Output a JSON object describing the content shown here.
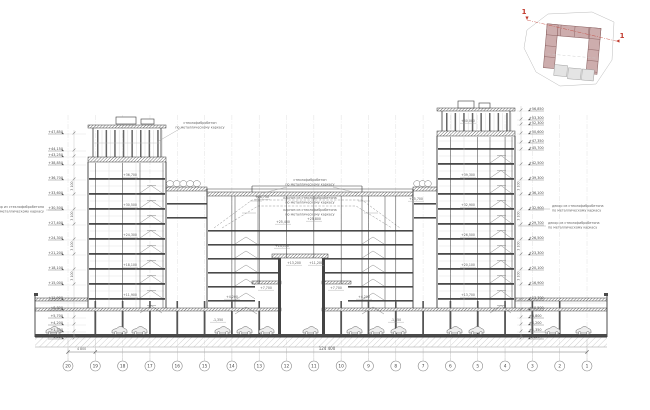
{
  "drawing_title": "Разрез 1-1",
  "grid": {
    "bubbles": [
      "20",
      "19",
      "18",
      "17",
      "16",
      "15",
      "14",
      "13",
      "12",
      "11",
      "10",
      "9",
      "8",
      "7",
      "6",
      "5",
      "4",
      "3",
      "2",
      "1"
    ]
  },
  "dimensions": {
    "overall": "124 400",
    "first_bay": "4 800",
    "floor_typical": "3 100",
    "floor_ground": "4 200"
  },
  "elevations": {
    "left": [
      {
        "y": 133,
        "label": "+47,850"
      },
      {
        "y": 150,
        "label": "+44,150"
      },
      {
        "y": 156,
        "label": "+43,250"
      },
      {
        "y": 164,
        "label": "+38,850"
      },
      {
        "y": 179,
        "label": "+36,700"
      },
      {
        "y": 194,
        "label": "+33,600"
      },
      {
        "y": 209,
        "label": "+30,500"
      },
      {
        "y": 224,
        "label": "+27,400"
      },
      {
        "y": 239,
        "label": "+24,300"
      },
      {
        "y": 254,
        "label": "+21,200"
      },
      {
        "y": 269,
        "label": "+18,100"
      },
      {
        "y": 284,
        "label": "+15,000"
      },
      {
        "y": 299,
        "label": "+11,900"
      },
      {
        "y": 309,
        "label": "+8,800"
      },
      {
        "y": 317,
        "label": "+5,700"
      },
      {
        "y": 324,
        "label": "+4,200"
      },
      {
        "y": 331,
        "label": "+1,350"
      },
      {
        "y": 338,
        "label": "-1,350"
      }
    ],
    "right": [
      {
        "y": 110,
        "label": "+56,850"
      },
      {
        "y": 119,
        "label": "+53,300"
      },
      {
        "y": 124,
        "label": "+52,300"
      },
      {
        "y": 133,
        "label": "+50,600"
      },
      {
        "y": 142,
        "label": "+47,350"
      },
      {
        "y": 149,
        "label": "+45,700"
      },
      {
        "y": 164,
        "label": "+42,500"
      },
      {
        "y": 179,
        "label": "+39,300"
      },
      {
        "y": 194,
        "label": "+36,100"
      },
      {
        "y": 209,
        "label": "+32,900"
      },
      {
        "y": 224,
        "label": "+29,700"
      },
      {
        "y": 239,
        "label": "+26,500"
      },
      {
        "y": 254,
        "label": "+23,300"
      },
      {
        "y": 269,
        "label": "+20,100"
      },
      {
        "y": 284,
        "label": "+16,900"
      },
      {
        "y": 299,
        "label": "+13,700"
      },
      {
        "y": 309,
        "label": "+10,500"
      },
      {
        "y": 317,
        "label": "+6,800"
      },
      {
        "y": 324,
        "label": "+4,200"
      },
      {
        "y": 331,
        "label": "+1,350"
      },
      {
        "y": 338,
        "label": "-1,350"
      }
    ],
    "interior": [
      {
        "x": 130,
        "y": 176,
        "label": "+36,700"
      },
      {
        "x": 130,
        "y": 206,
        "label": "+30,500"
      },
      {
        "x": 130,
        "y": 236,
        "label": "+24,300"
      },
      {
        "x": 130,
        "y": 266,
        "label": "+18,100"
      },
      {
        "x": 130,
        "y": 296,
        "label": "+11,900"
      },
      {
        "x": 468,
        "y": 176,
        "label": "+39,300"
      },
      {
        "x": 468,
        "y": 206,
        "label": "+32,900"
      },
      {
        "x": 468,
        "y": 236,
        "label": "+26,500"
      },
      {
        "x": 468,
        "y": 266,
        "label": "+20,100"
      },
      {
        "x": 468,
        "y": 296,
        "label": "+13,700"
      },
      {
        "x": 468,
        "y": 122,
        "label": "+50,000"
      },
      {
        "x": 262,
        "y": 198,
        "label": "+28,750"
      },
      {
        "x": 283,
        "y": 223,
        "label": "+25,400"
      },
      {
        "x": 314,
        "y": 220,
        "label": "+25,800"
      },
      {
        "x": 416,
        "y": 200,
        "label": "+25,700"
      },
      {
        "x": 282,
        "y": 247,
        "label": "+14,170"
      },
      {
        "x": 294,
        "y": 264,
        "label": "+13,200"
      },
      {
        "x": 316,
        "y": 264,
        "label": "+11,200"
      },
      {
        "x": 266,
        "y": 289,
        "label": "+7,700"
      },
      {
        "x": 336,
        "y": 289,
        "label": "+7,700"
      },
      {
        "x": 232,
        "y": 298,
        "label": "+4,200"
      },
      {
        "x": 364,
        "y": 298,
        "label": "+4,200"
      },
      {
        "x": 218,
        "y": 321,
        "label": "-1,350"
      },
      {
        "x": 396,
        "y": 321,
        "label": "-1,350"
      }
    ]
  },
  "annotations": [
    {
      "x": 200,
      "y": 124,
      "anchor": "middle",
      "lines": [
        "стеклофибробетон",
        "по металлическому каркасу"
      ],
      "leader": [
        [
          183,
          127
        ],
        [
          157,
          142
        ]
      ]
    },
    {
      "x": 310,
      "y": 181,
      "anchor": "middle",
      "lines": [
        "стеклофибробетон",
        "по металлическому каркасу"
      ],
      "leader": []
    },
    {
      "x": 310,
      "y": 199,
      "anchor": "middle",
      "lines": [
        "карниз из стеклофибробетона",
        "по металлическому каркасу"
      ],
      "leader": []
    },
    {
      "x": 310,
      "y": 211,
      "anchor": "middle",
      "lines": [
        "карниз из стеклофибробетона",
        "по металлическому каркасу"
      ],
      "leader": []
    },
    {
      "x": 44,
      "y": 208,
      "anchor": "end",
      "lines": [
        "декор из стеклофибробетона",
        "по металлическому каркасу"
      ],
      "leader": [
        [
          46,
          210
        ],
        [
          62,
          210
        ]
      ]
    },
    {
      "x": 552,
      "y": 207,
      "anchor": "start",
      "lines": [
        "декор из стеклофибробетона",
        "по металлическому каркасу"
      ],
      "leader": [
        [
          550,
          209
        ],
        [
          532,
          209
        ]
      ]
    },
    {
      "x": 548,
      "y": 224,
      "anchor": "start",
      "lines": [
        "декор из стеклофибробетона",
        "по металлическому каркасу"
      ],
      "leader": [
        [
          546,
          226
        ],
        [
          518,
          226
        ]
      ]
    }
  ],
  "keyplan": {
    "section_mark": "1",
    "colors": {
      "accent": "#c23b2e",
      "building_fill": "#cdadad",
      "building_outline": "#8a6161",
      "site_outline": "#bcbcbc",
      "block_fill": "#e4e4e4"
    }
  },
  "colors": {
    "line": "#3a3a3a",
    "slab": "#4a4a4a",
    "light": "#9a9a9a",
    "faint": "#d5d5d5",
    "red": "#c23b2e"
  }
}
